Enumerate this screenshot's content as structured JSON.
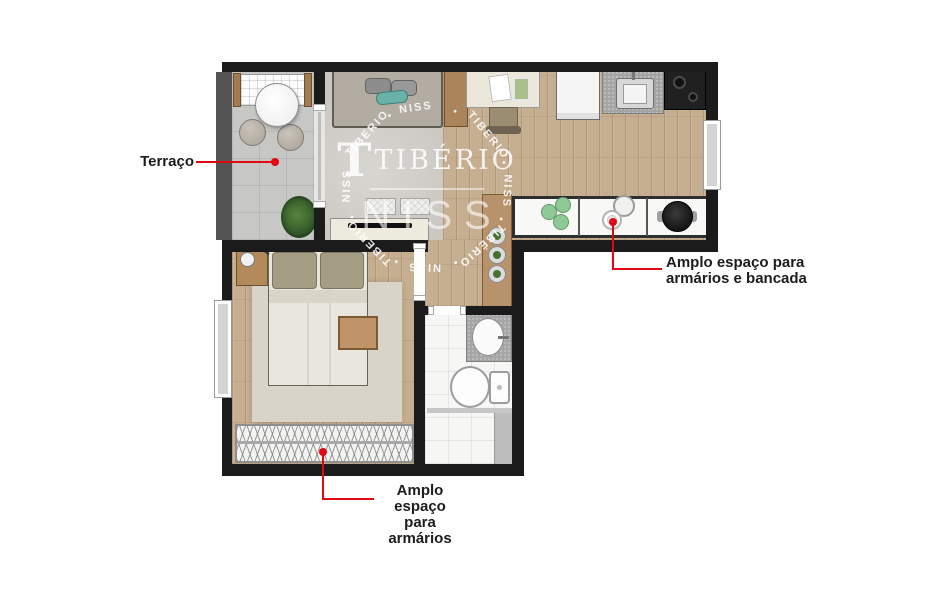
{
  "annotations": {
    "terrace": {
      "label": "Terraço"
    },
    "counter": {
      "line1": "Amplo espaço para",
      "line2": "armários e bancada"
    },
    "wardrobe": {
      "line1": "Amplo espaço",
      "line2": "para armários"
    }
  },
  "watermark": {
    "logo_initial": "T",
    "logo_text": "TIBÉRIO",
    "sub_text": "NISS",
    "ring": [
      {
        "text": "NISS",
        "angle": 352
      },
      {
        "text": "•",
        "angle": 21
      },
      {
        "text": "TIBERIO",
        "angle": 50
      },
      {
        "text": "•",
        "angle": 73
      },
      {
        "text": "NISS",
        "angle": 93
      },
      {
        "text": "•",
        "angle": 114
      },
      {
        "text": "TIBÉRIO",
        "angle": 137
      },
      {
        "text": "•",
        "angle": 160
      },
      {
        "text": "NISS",
        "angle": 182
      },
      {
        "text": "•",
        "angle": 203
      },
      {
        "text": "TIBERIO",
        "angle": 226
      },
      {
        "text": "•",
        "angle": 249
      },
      {
        "text": "NISS",
        "angle": 271
      },
      {
        "text": "•",
        "angle": 291
      },
      {
        "text": "TIBERIO",
        "angle": 312
      },
      {
        "text": "•",
        "angle": 333
      }
    ]
  },
  "colors": {
    "annotation_red": "#e30613",
    "wall_black": "#1b1b1b",
    "wood_floor": "#c6ae90",
    "living_carpet": "#cbc8c2",
    "terrace_tile": "#c7c7c5",
    "accent_teal": "#68b2aa",
    "watermark_white": "#ffffff"
  }
}
